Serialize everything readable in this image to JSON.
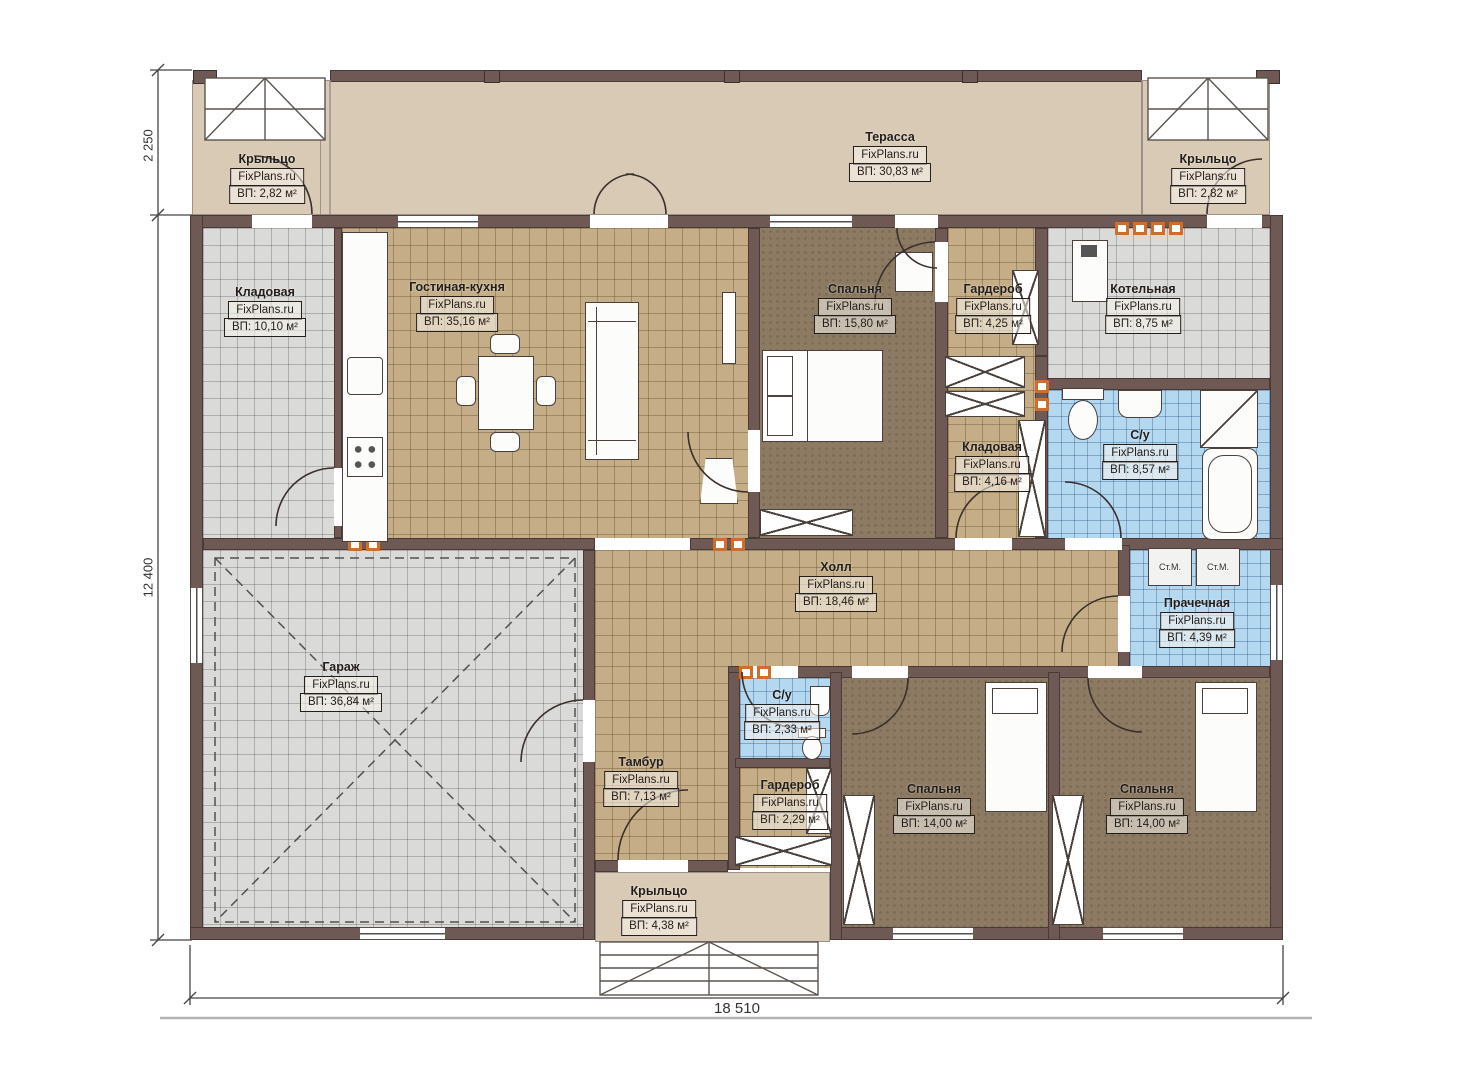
{
  "plan": {
    "watermark": "FixPlans.ru",
    "rooms": [
      {
        "id": "porch-top-left",
        "name": "Крыльцо",
        "area": "ВП: 2,82 м²"
      },
      {
        "id": "terrace",
        "name": "Терасса",
        "area": "ВП: 30,83 м²"
      },
      {
        "id": "porch-top-right",
        "name": "Крыльцо",
        "area": "ВП: 2,82 м²"
      },
      {
        "id": "storeroom-left",
        "name": "Кладовая",
        "area": "ВП: 10,10 м²"
      },
      {
        "id": "living-kitchen",
        "name": "Гостиная-кухня",
        "area": "ВП: 35,16 м²"
      },
      {
        "id": "bedroom-top",
        "name": "Спальня",
        "area": "ВП: 15,80 м²"
      },
      {
        "id": "wardrobe-top",
        "name": "Гардероб",
        "area": "ВП: 4,25 м²"
      },
      {
        "id": "boiler-room",
        "name": "Котельная",
        "area": "ВП: 8,75 м²"
      },
      {
        "id": "storeroom-inner",
        "name": "Кладовая",
        "area": "ВП: 4,16 м²"
      },
      {
        "id": "bathroom-main",
        "name": "С/у",
        "area": "ВП: 8,57 м²"
      },
      {
        "id": "hall",
        "name": "Холл",
        "area": "ВП: 18,46 м²"
      },
      {
        "id": "laundry",
        "name": "Прачечная",
        "area": "ВП: 4,39 м²"
      },
      {
        "id": "garage",
        "name": "Гараж",
        "area": "ВП: 36,84 м²"
      },
      {
        "id": "vestibule",
        "name": "Тамбур",
        "area": "ВП: 7,13 м²"
      },
      {
        "id": "bathroom-small",
        "name": "С/у",
        "area": "ВП: 2,33 м²"
      },
      {
        "id": "wardrobe-small",
        "name": "Гардероб",
        "area": "ВП: 2,29 м²"
      },
      {
        "id": "bedroom-left",
        "name": "Спальня",
        "area": "ВП: 14,00 м²"
      },
      {
        "id": "bedroom-right",
        "name": "Спальня",
        "area": "ВП: 14,00 м²"
      },
      {
        "id": "porch-bottom",
        "name": "Крыльцо",
        "area": "ВП: 4,38 м²"
      }
    ],
    "appliances": {
      "washing_machine": "Ст.М."
    },
    "dimensions": {
      "left_top": "2 250",
      "left_main": "12 400",
      "bottom": "18 510"
    },
    "colors": {
      "wall": "#6e5955",
      "terrace_floor": "#d9cab6",
      "tile_floor": "#c5ae87",
      "bedroom_floor": "#8c7a62",
      "utility_floor": "#dadad8",
      "wet_floor": "#b5d8f1",
      "vent_accent": "#cf6d2a"
    }
  }
}
